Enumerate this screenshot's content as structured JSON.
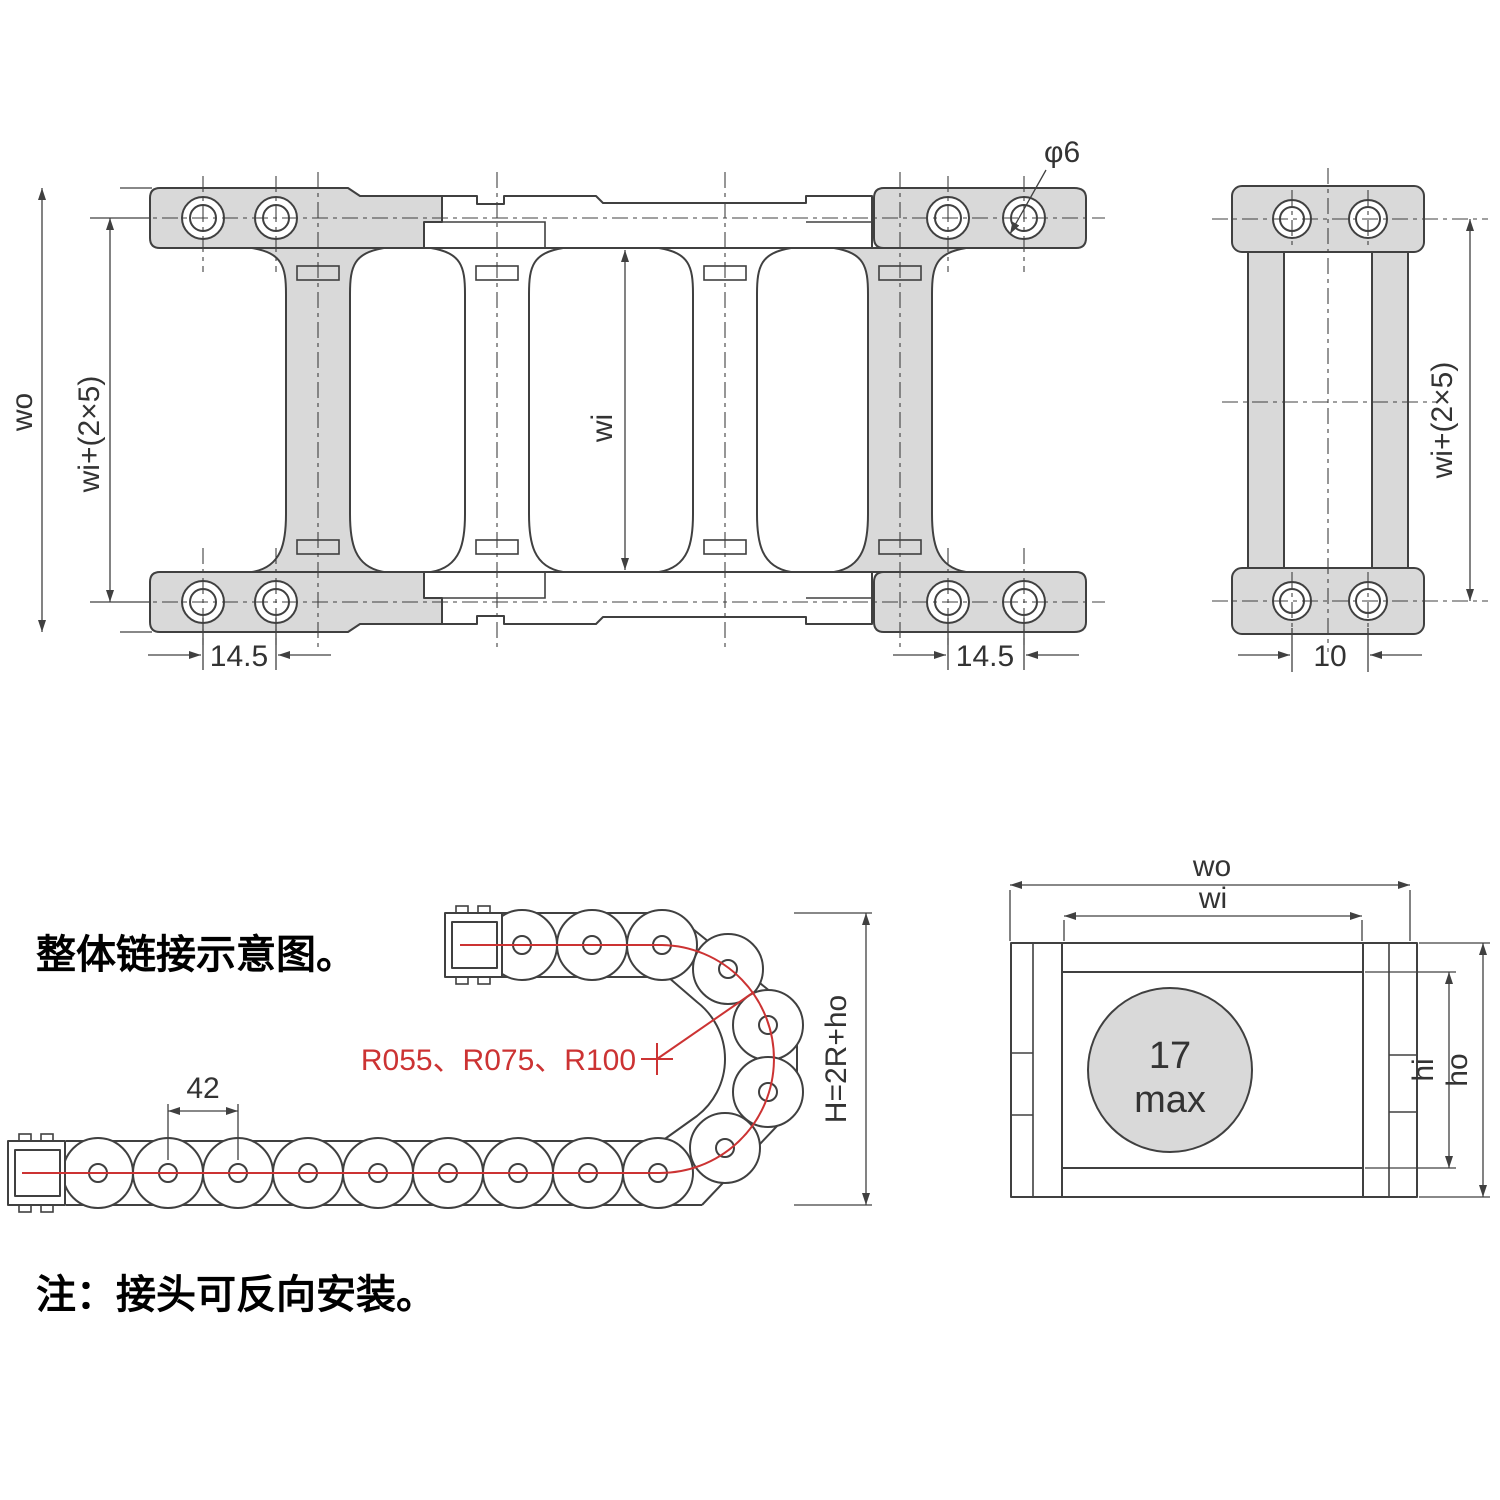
{
  "colors": {
    "line": "#404040",
    "fill_gray": "#d9d9d9",
    "accent_red": "#cc3333",
    "background": "#ffffff"
  },
  "notes": {
    "caption": "整体链接示意图。",
    "footnote": "注：接头可反向安装。"
  },
  "plan_view": {
    "dim_outer_width": "wo",
    "dim_bolt_span": "wi+(2×5)",
    "dim_inner_width": "wi",
    "dim_hole_diameter": "φ6",
    "dim_hole_pitch_left": "14.5",
    "dim_hole_pitch_right": "14.5"
  },
  "side_view": {
    "dim_bolt_span": "wi+(2×5)",
    "dim_hole_pitch": "10"
  },
  "bend_view": {
    "dim_link_pitch": "42",
    "bend_radii": "R055、R075、R100",
    "dim_height_formula": "H=2R+ho"
  },
  "section_view": {
    "dim_outer_width": "wo",
    "dim_inner_width": "wi",
    "dim_inner_height": "hi",
    "dim_outer_height": "ho",
    "cable_diameter_value": "17",
    "cable_diameter_qualifier": "max"
  }
}
